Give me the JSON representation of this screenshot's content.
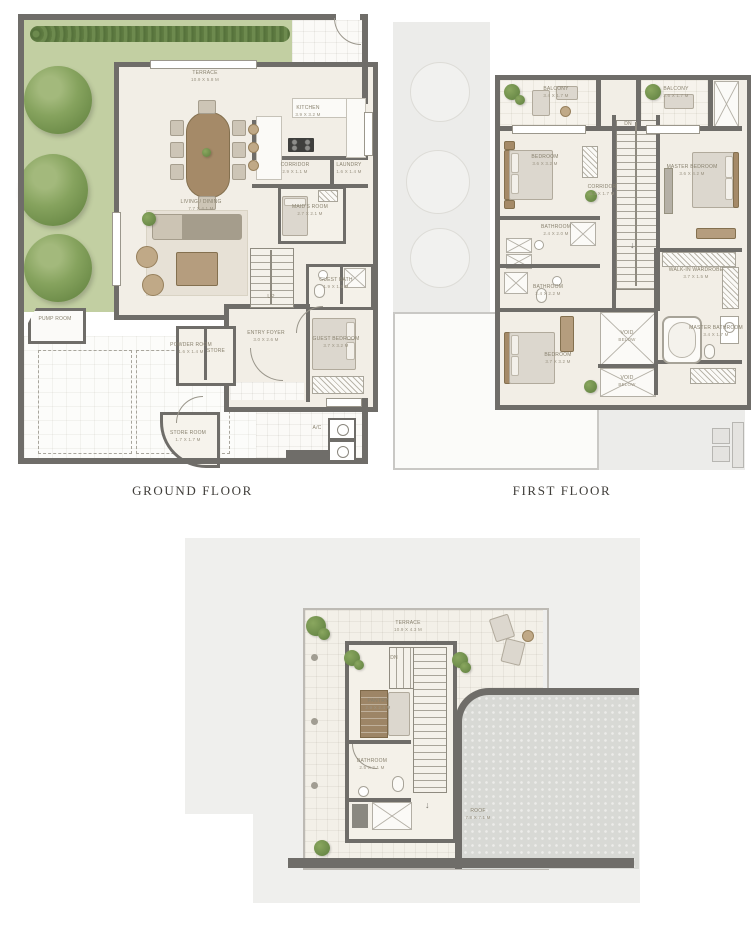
{
  "captions": {
    "ground": "GROUND FLOOR",
    "first": "FIRST FLOOR"
  },
  "icons": {
    "down_arrow": "↓"
  },
  "colors": {
    "wall": "#6f6d69",
    "grass": "#c2cfa2",
    "hedge": "#5d7a44",
    "tree": "#7d9b55",
    "floor": "#f2eee6",
    "concrete": "#d8d9d5",
    "ghost": "#ececea",
    "label_text": "#89826f",
    "caption_text": "#403e3a"
  },
  "ground": {
    "terrace": {
      "name": "TERRACE",
      "dim": "10.9 x 5.8 M"
    },
    "kitchen": {
      "name": "KITCHEN",
      "dim": "3.9 x 3.2 M"
    },
    "corridor": {
      "name": "CORRIDOR",
      "dim": "2.9 x 1.1 M"
    },
    "laundry": {
      "name": "LAUNDRY",
      "dim": "1.6 x 1.4 M"
    },
    "living": {
      "name": "LIVING / DINING",
      "dim": "7.7 x 4.1 M"
    },
    "maid": {
      "name": "MAID'S ROOM",
      "dim": "2.7 x 2.1 M"
    },
    "powder": {
      "name": "POWDER ROOM",
      "dim": "1.6 x 1.4 M"
    },
    "store_small": {
      "name": "STORE",
      "dim": ""
    },
    "foyer": {
      "name": "ENTRY FOYER",
      "dim": "3.0 x 2.6 M"
    },
    "guest_bath": {
      "name": "GUEST BATH",
      "dim": "1.9 x 1.6 M"
    },
    "guest_bed": {
      "name": "GUEST BEDROOM",
      "dim": "3.7 x 3.2 M"
    },
    "pump": {
      "name": "PUMP ROOM",
      "dim": ""
    },
    "store_room": {
      "name": "STORE ROOM",
      "dim": "1.7 x 1.7 M"
    },
    "ac": {
      "name": "A/C",
      "dim": ""
    },
    "up": "UP"
  },
  "first": {
    "balcony_left": {
      "name": "BALCONY",
      "dim": "3.4 x 1.7 M"
    },
    "balcony_right": {
      "name": "BALCONY",
      "dim": "2.6 x 1.7 M"
    },
    "bedroom2": {
      "name": "BEDROOM",
      "dim": "3.6 x 3.2 M"
    },
    "master": {
      "name": "MASTER BEDROOM",
      "dim": "3.6 x 4.2 M"
    },
    "corridor": {
      "name": "CORRIDOR",
      "dim": "4.4 x 1.7 M"
    },
    "walkin": {
      "name": "WALK-IN WARDROBE",
      "dim": "3.7 x 1.5 M"
    },
    "bath2": {
      "name": "BATHROOM",
      "dim": "2.4 x 2.0 M"
    },
    "bath3": {
      "name": "BATHROOM",
      "dim": "2.4 x 2.2 M"
    },
    "bedroom3": {
      "name": "BEDROOM",
      "dim": "3.7 x 3.2 M"
    },
    "void1": {
      "name": "VOID",
      "dim": "BELOW"
    },
    "void2": {
      "name": "VOID",
      "dim": "BELOW"
    },
    "master_bath": {
      "name": "MASTER BATHROOM",
      "dim": "3.4 x 1.7 M"
    },
    "dn": "DN"
  },
  "roof": {
    "terrace": {
      "name": "TERRACE",
      "dim": "10.9 x 4.3 M"
    },
    "pantry": {
      "name": "PANTRY",
      "dim": "2.9 x 2.4 M"
    },
    "bathroom": {
      "name": "BATHROOM",
      "dim": "2.5 x 2.1 M"
    },
    "roof_slab": {
      "name": "ROOF",
      "dim": "7.8 x 7.1 M"
    },
    "dn": "DN"
  }
}
